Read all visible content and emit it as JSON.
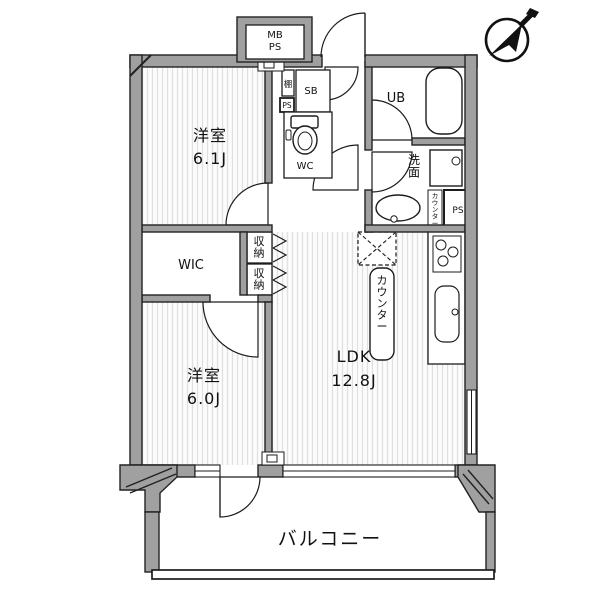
{
  "plan": {
    "type": "apartment-floor-plan",
    "rooms": {
      "bedroom1_name": "洋室",
      "bedroom1_size": "6.1J",
      "bedroom2_name": "洋室",
      "bedroom2_size": "6.0J",
      "ldk_name": "LDK",
      "ldk_size": "12.8J",
      "wic": "WIC",
      "wc": "WC",
      "unit_bath": "UB",
      "washroom": "洗面",
      "balcony": "バルコニー",
      "storage_a": "収納",
      "storage_b": "収納",
      "counter": "カウンター",
      "counter_small": "カウンター",
      "shelf": "棚",
      "shutter_box": "SB",
      "pipe_space_hall": "PS",
      "pipe_space_kitchen": "PS",
      "meter_box": "MB",
      "meter_box_ps": "PS"
    },
    "compass": "north-east",
    "colors": {
      "wall": "#a0a0a0",
      "outline": "#1c1c1c",
      "hatch_stripe": "#e0e0e0",
      "floor": "#ffffff",
      "text": "#111111"
    }
  }
}
